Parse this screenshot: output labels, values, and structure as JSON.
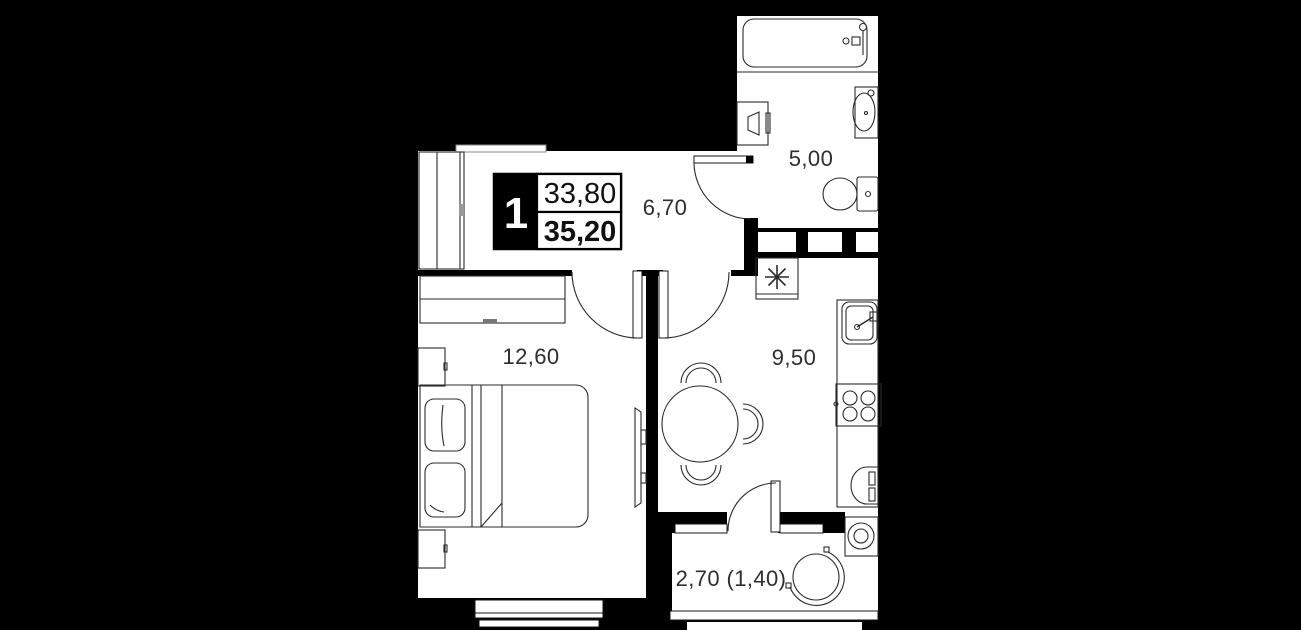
{
  "plan": {
    "info_block": {
      "rooms_count": "1",
      "area_top": "33,80",
      "area_bottom": "35,20"
    },
    "rooms": [
      {
        "key": "bathroom",
        "area_label": "5,00"
      },
      {
        "key": "hallway",
        "area_label": "6,70"
      },
      {
        "key": "bedroom",
        "area_label": "12,60"
      },
      {
        "key": "kitchen",
        "area_label": "9,50"
      },
      {
        "key": "balcony",
        "area_label": "2,70 (1,40)"
      }
    ],
    "colors": {
      "background": "#000000",
      "floor": "#ffffff",
      "line": "#2a2a2a",
      "text": "#2e2e2e"
    }
  }
}
